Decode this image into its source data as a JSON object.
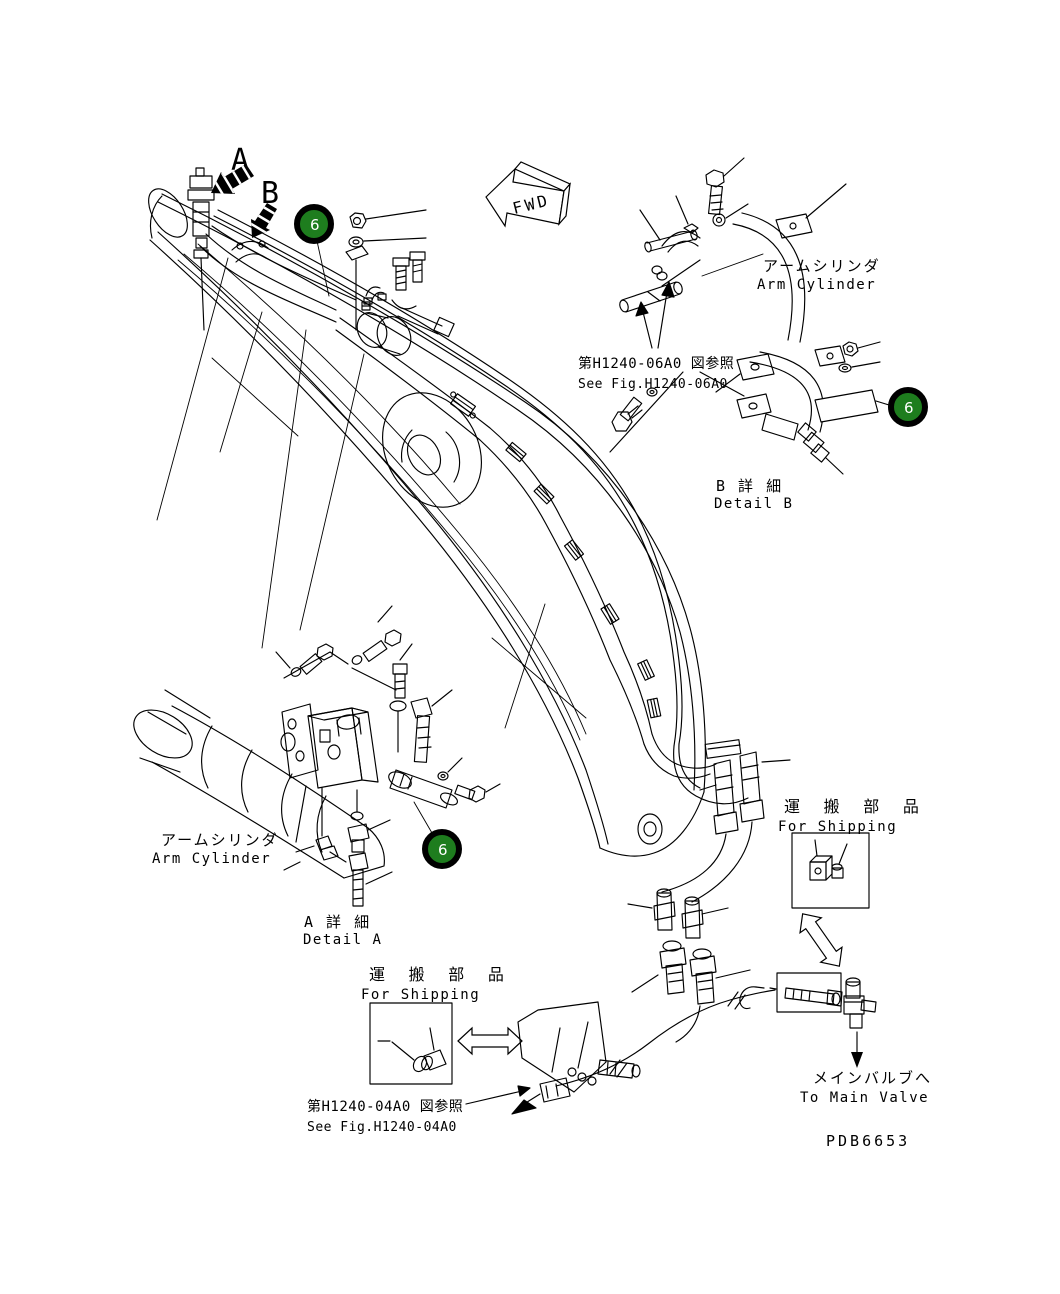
{
  "labels": {
    "view_a": "A",
    "view_b": "B",
    "fwd": "FWD"
  },
  "callouts": {
    "number": "6",
    "fill": "#1e7d1e",
    "text_color": "#ffffff"
  },
  "detail_b": {
    "component_jp": "アームシリンダ",
    "component_en": "Arm Cylinder",
    "reference_jp": "第H1240-06A0 図参照",
    "reference_en": "See Fig.H1240-06A0",
    "title_jp": "B 詳 細",
    "title_en": "Detail B"
  },
  "detail_a": {
    "component_jp": "アームシリンダ",
    "component_en": "Arm Cylinder",
    "title_jp": "A 詳 細",
    "title_en": "Detail A"
  },
  "shipping_left": {
    "label_jp": "運 搬 部 品",
    "label_en": "For Shipping",
    "reference_jp": "第H1240-04A0 図参照",
    "reference_en": "See Fig.H1240-04A0"
  },
  "shipping_right": {
    "label_jp": "運 搬 部 品",
    "label_en": "For Shipping",
    "destination_jp": "メインバルブへ",
    "destination_en": "To Main Valve"
  },
  "drawing_number": "PDB6653"
}
